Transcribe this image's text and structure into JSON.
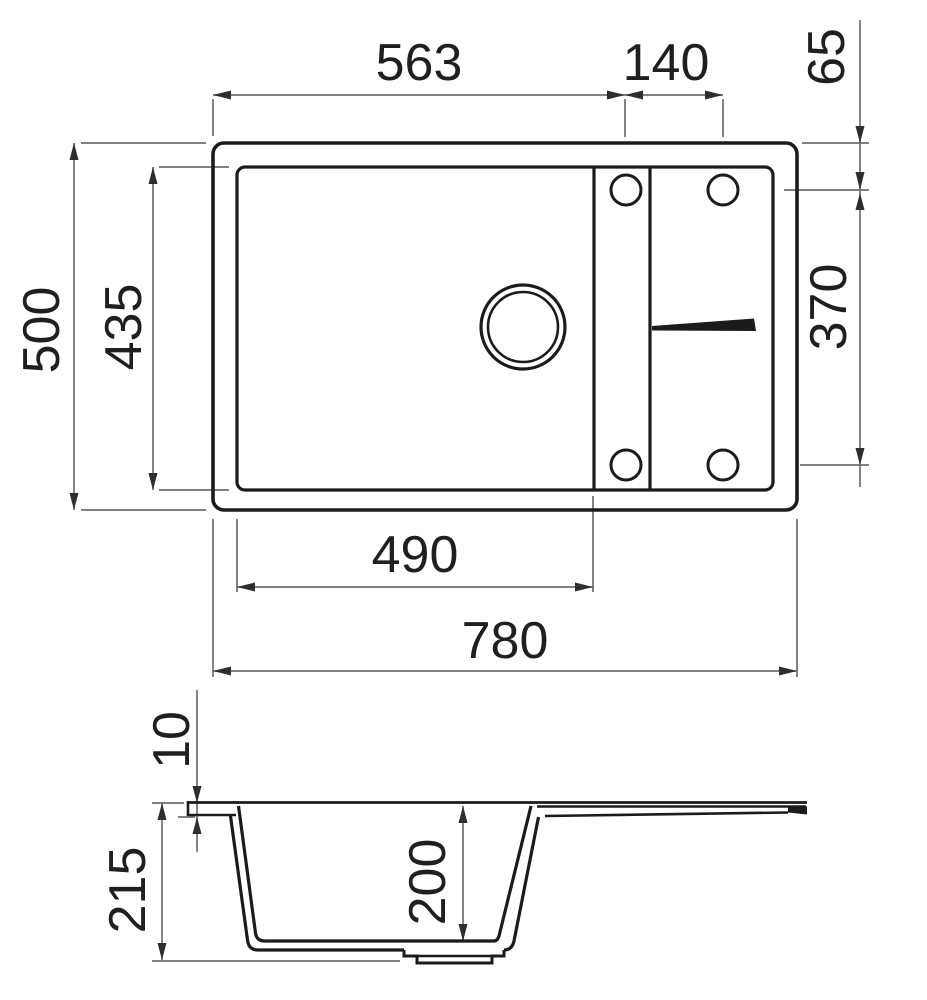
{
  "dims": {
    "top_view": {
      "left_edge_to_tap_hole_column": "563",
      "tap_hole_column_spacing": "140",
      "top_edge_to_tap_hole_row": "65",
      "overall_depth": "500",
      "bowl_inner_depth": "435",
      "tap_hole_row_spacing": "370",
      "bowl_inner_width": "490",
      "overall_width": "780"
    },
    "side_view": {
      "rim_thickness": "10",
      "overall_height": "215",
      "bowl_inner_height": "200"
    }
  },
  "colors": {
    "object_line": "#1b1b1b",
    "dimension_line": "#6e6e6e",
    "arrow": "#2e2e2e",
    "background": "#ffffff"
  }
}
